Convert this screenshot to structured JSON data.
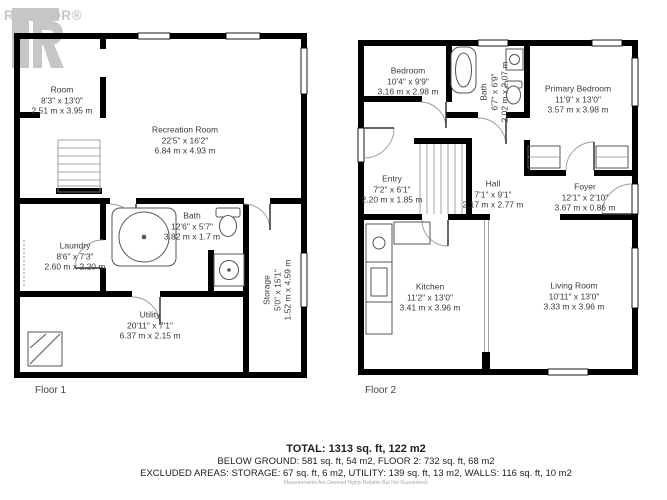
{
  "watermark": {
    "brand": "REALTOR®"
  },
  "floor1": {
    "label": "Floor 1",
    "rooms": [
      {
        "name": "Room",
        "imperial": "8'3\" x 13'0\"",
        "metric": "2.51 m x 3.95 m"
      },
      {
        "name": "Recreation Room",
        "imperial": "22'5\" x 16'2\"",
        "metric": "6.84 m x 4.93 m"
      },
      {
        "name": "Bath",
        "imperial": "12'6\" x 5'7\"",
        "metric": "3.82 m x 1.7 m"
      },
      {
        "name": "Laundry",
        "imperial": "8'6\" x 7'3\"",
        "metric": "2.60 m x 2.20 m"
      },
      {
        "name": "Utility",
        "imperial": "20'11\" x 7'1\"",
        "metric": "6.37 m x 2.15 m"
      },
      {
        "name": "Storage",
        "imperial": "5'0\" x 15'1\"",
        "metric": "1.52 m x 4.59 m"
      }
    ]
  },
  "floor2": {
    "label": "Floor 2",
    "rooms": [
      {
        "name": "Bedroom",
        "imperial": "10'4\" x 9'9\"",
        "metric": "3.16 m x 2.98 m"
      },
      {
        "name": "Bath",
        "imperial": "6'7\" x 6'9\"",
        "metric": "2.02 m x 2.07 m"
      },
      {
        "name": "Primary Bedroom",
        "imperial": "11'9\" x 13'0\"",
        "metric": "3.57 m x 3.98 m"
      },
      {
        "name": "Entry",
        "imperial": "7'2\" x 6'1\"",
        "metric": "2.20 m x 1.85 m"
      },
      {
        "name": "Hall",
        "imperial": "7'1\" x 9'1\"",
        "metric": "2.17 m x 2.77 m"
      },
      {
        "name": "Foyer",
        "imperial": "12'1\" x 2'10\"",
        "metric": "3.67 m x 0.86 m"
      },
      {
        "name": "Kitchen",
        "imperial": "11'2\" x 13'0\"",
        "metric": "3.41 m x 3.96 m"
      },
      {
        "name": "Living Room",
        "imperial": "10'11\" x 13'0\"",
        "metric": "3.33 m x 3.96 m"
      }
    ]
  },
  "summary": {
    "total": "TOTAL: 1313 sq. ft, 122 m2",
    "floors": "BELOW GROUND: 581 sq. ft, 54 m2, FLOOR 2: 732 sq. ft, 68 m2",
    "excluded": "EXCLUDED AREAS: STORAGE: 67 sq. ft, 6 m2, UTILITY: 139 sq. ft, 13 m2, WALLS: 116 sq. ft, 10 m2",
    "disclaimer": "Measurements Are Deemed Highly Reliable But Not Guaranteed."
  }
}
